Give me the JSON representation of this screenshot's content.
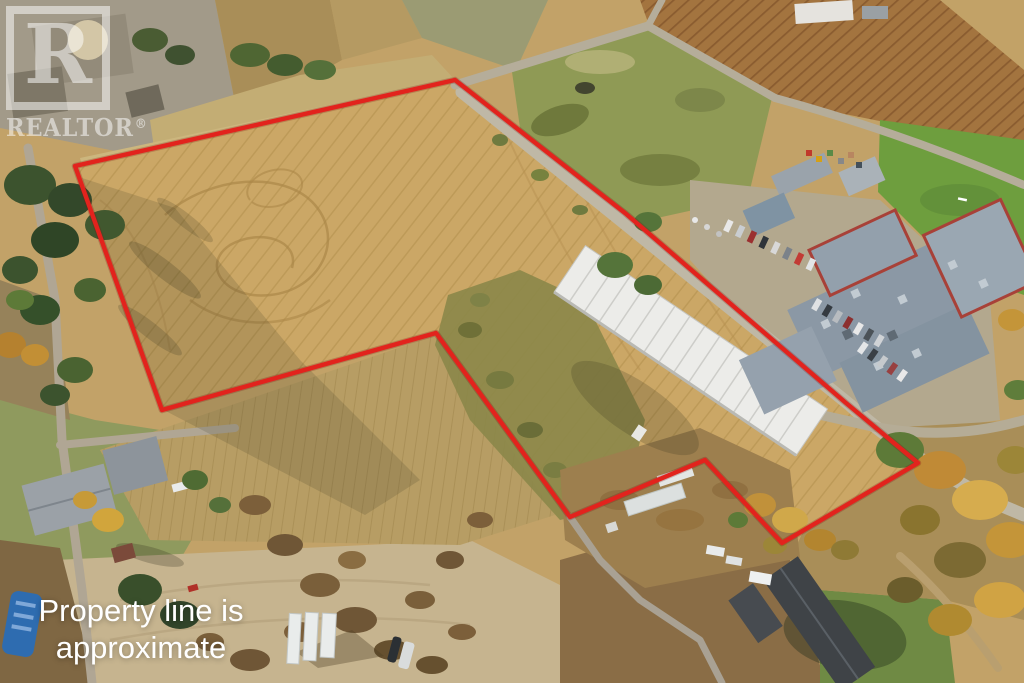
{
  "watermark": {
    "square_letter": "R",
    "brand": "REALTOR",
    "registered": "®"
  },
  "caption": {
    "line1": "Property line is",
    "line2": "approximate"
  },
  "property_line": {
    "color": "#e2231d",
    "stroke_width": 4.4,
    "points": "455,80 625,213 846,403 918,463 782,543 705,460 570,517 436,333 162,410 75,166"
  },
  "palette": {
    "field_gold": "#cba766",
    "field_pale": "#c6b48f",
    "field_rows": "#b79d64",
    "green_pasture": "#8f9a55",
    "sports_lawn": "#6e9e3e",
    "lawn": "#8f9a5e",
    "road_grey": "#bdb5a2",
    "ploughed_brown": "#a3743f",
    "scrub_brown": "#7c5f3a",
    "school_roof": "#8b98a5",
    "school_trim_red": "#a84138",
    "warehouse_white": "#ecece9",
    "dark_roof": "#3f4347",
    "conifer_green": "#3a512c",
    "autumn_orange": "#c08a36",
    "boundary_red": "#e2231d"
  }
}
